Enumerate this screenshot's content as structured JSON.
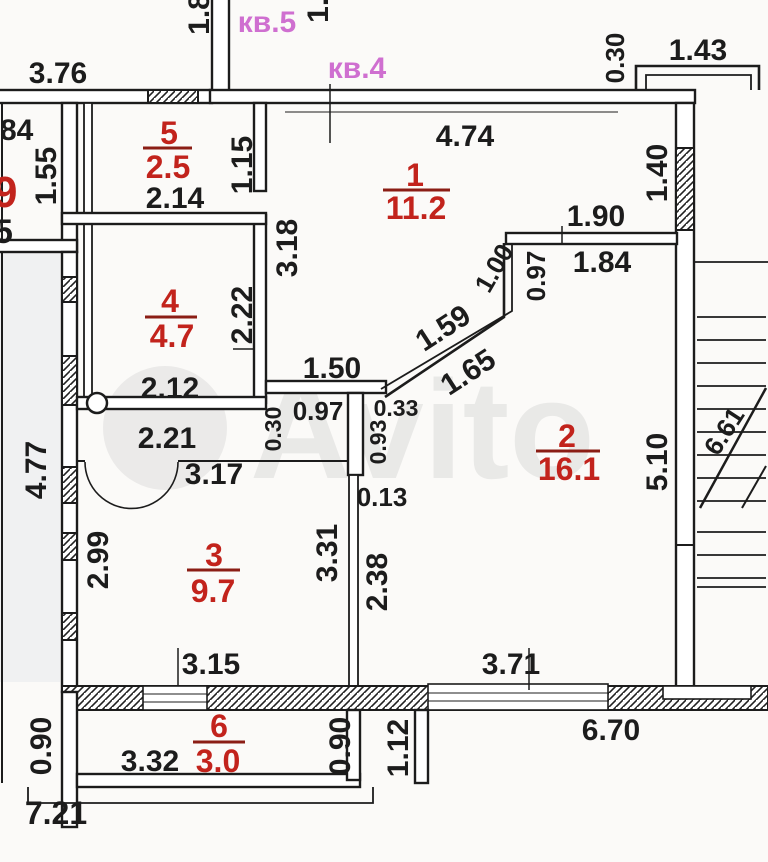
{
  "watermark": "Avito",
  "apartment_labels": {
    "kv5": "кв.5",
    "kv4": "кв.4"
  },
  "rooms": [
    {
      "number": "1",
      "area": "11.2"
    },
    {
      "number": "2",
      "area": "16.1"
    },
    {
      "number": "3",
      "area": "9.7"
    },
    {
      "number": "4",
      "area": "4.7"
    },
    {
      "number": "5",
      "area": "2.5"
    },
    {
      "number": "6",
      "area": "3.0"
    }
  ],
  "neighbor": {
    "dim_84": "84",
    "dim_155": "1.55",
    "area_9": "9",
    "dim_5": "5"
  },
  "dims": {
    "top_width": "3.76",
    "top_wall_18": "1.8",
    "top_wall_15": "1.5",
    "balcony_offset": "0.30",
    "balcony_width": "1.43",
    "room1_top": "4.74",
    "room1_318": "3.18",
    "room1_190": "1.90",
    "room1_184": "1.84",
    "room1_097": "0.97",
    "room1_100": "1.00",
    "room1_159": "1.59",
    "room1_165": "1.65",
    "room1_140": "1.40",
    "room5_width": "2.14",
    "room5_115": "1.15",
    "room4_222": "2.22",
    "room4_width": "2.12",
    "hall_150": "1.50",
    "hall_030": "0.30",
    "hall_097": "0.97",
    "hall_033": "0.33",
    "hall_093": "0.93",
    "hall_013": "0.13",
    "hall_221": "2.21",
    "hall_317": "3.17",
    "left_477": "4.77",
    "room3_299": "2.99",
    "room3_331": "3.31",
    "room3_238": "2.38",
    "room3_315": "3.15",
    "room2_510": "5.10",
    "room2_371": "3.71",
    "stairs_661": "6.61",
    "bottom_670": "6.70",
    "bottom_112": "1.12",
    "room6_332": "3.32",
    "room6_090_left": "0.90",
    "room6_090_right": "0.90",
    "bottom_721": "7.21"
  },
  "colors": {
    "walls": "#1c1c1c",
    "room_labels": "#c2231c",
    "apartment_labels": "#cf6fd0",
    "watermark": "#c6c6c6",
    "paper": "#fbfaf8"
  }
}
